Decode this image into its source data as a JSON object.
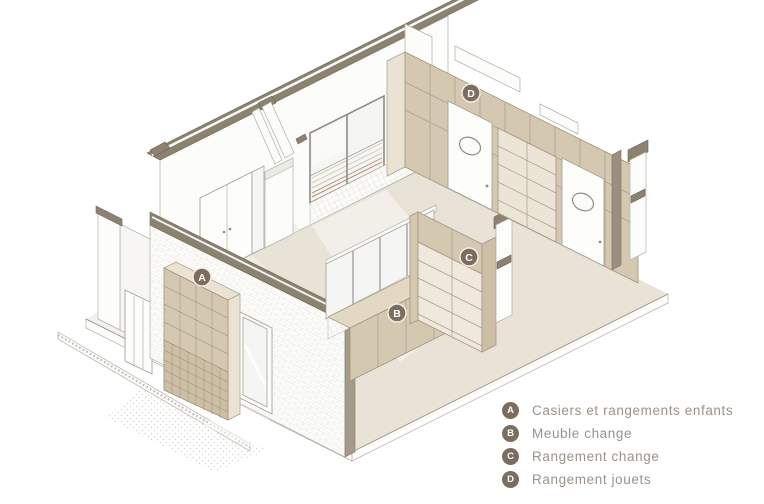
{
  "figure": {
    "markers": [
      {
        "letter": "A"
      },
      {
        "letter": "B"
      },
      {
        "letter": "C"
      },
      {
        "letter": "D"
      }
    ]
  },
  "legend": {
    "items": [
      {
        "key": "A",
        "label": "Casiers et rangements enfants"
      },
      {
        "key": "B",
        "label": "Meuble change"
      },
      {
        "key": "C",
        "label": "Rangement change"
      },
      {
        "key": "D",
        "label": "Rangement jouets"
      }
    ]
  },
  "colors": {
    "background": "#ffffff",
    "cut_band": "#8c8270",
    "cabinet_tan": "#d5c8b1",
    "cabinet_tan_light": "#eae2d2",
    "cabinet_tan_dark": "#cdbfa6",
    "floor_interior": "#e8e2d7",
    "floor_exterior": "#f2f1ee",
    "outline_gray": "#b3afa7",
    "outline_tan": "#ab9d85",
    "marker_bg": "#7c6d5f",
    "marker_text": "#ffffff",
    "legend_text": "#9b9289",
    "glass": "#f5f6f3"
  }
}
